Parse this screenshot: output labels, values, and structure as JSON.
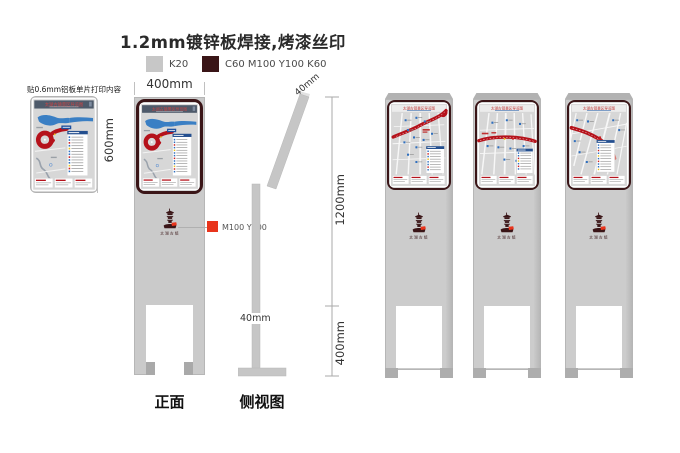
{
  "title": "1.2mm镀锌板焊接,烤漆丝印",
  "legend": {
    "gray_label": "K20",
    "dark_label": "C60 M100 Y100 K60"
  },
  "annotations": {
    "aluminum_note": "贴0.6mm铝板单片打印内容",
    "logo_color_label": "M100 Y100"
  },
  "dimensions": {
    "panel_width": "400mm",
    "panel_height": "600mm",
    "stand_height": "1200mm",
    "base_height": "400mm",
    "top_thickness": "40mm",
    "pole_thickness": "40mm"
  },
  "views": {
    "front_label": "正面",
    "side_label": "侧视图"
  },
  "map": {
    "title": "太湖古镇景区导览图",
    "logo_text": "太湖古镇"
  },
  "colors": {
    "k20_gray": "#c8c8c8",
    "frame_maroon": "#3a1517",
    "logo_red": "#e8341c",
    "route_red": "#b5121b",
    "water_blue": "#3a7fc4"
  }
}
